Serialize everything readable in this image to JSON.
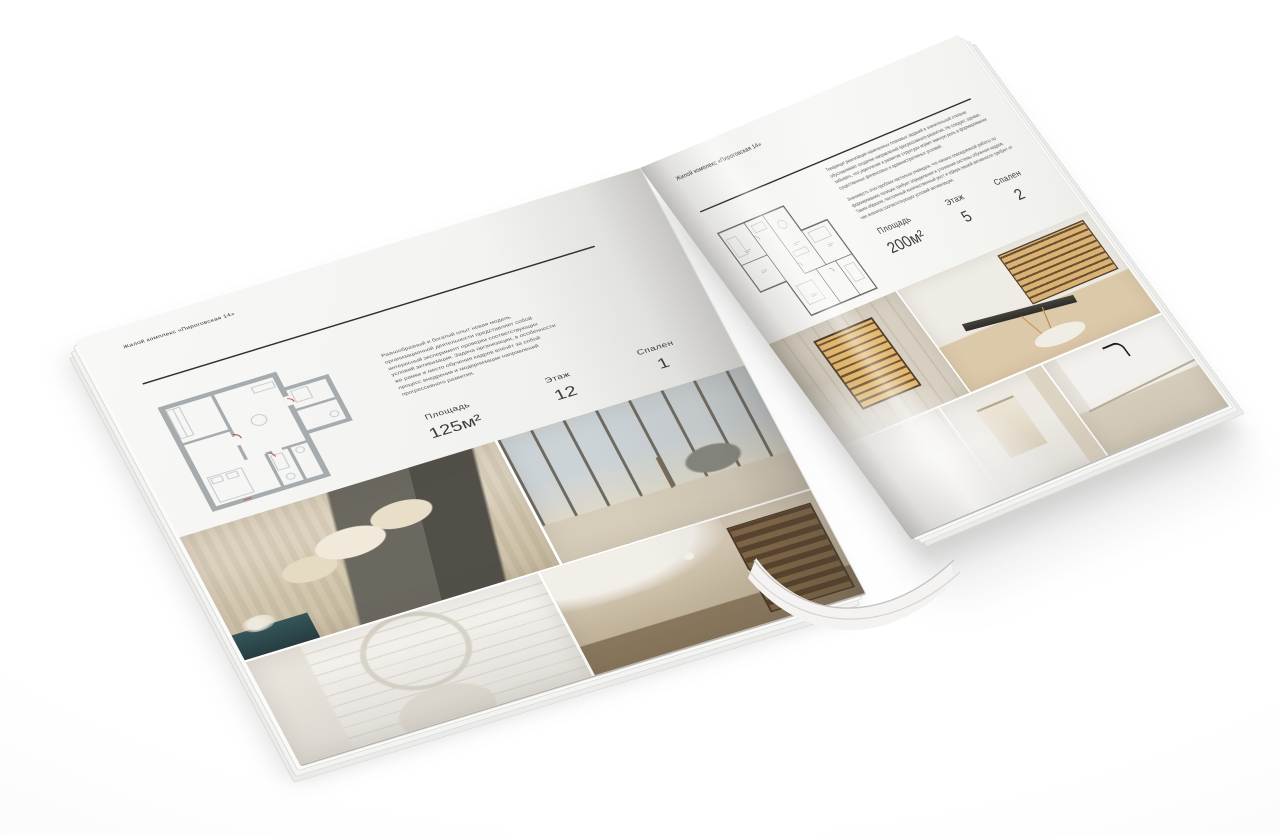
{
  "scene": {
    "background": "#ffffff",
    "shadow_color": "rgba(62,60,56,0.17)",
    "palette": {
      "paper": "#f5f4f2",
      "ink": "#2f2f2f",
      "plan_wall_gray": "#a6abae",
      "plan_line_dark": "#6e6e6e",
      "plan_accent_red": "#c0524c",
      "photo_beige": "#cdc2ab",
      "photo_gold": "#e3b76e",
      "photo_teal": "#35565a"
    }
  },
  "brochure": {
    "title": "Жилой комплекс «Пироговская 14»",
    "left_page": {
      "header": "Жилой комплекс «Пироговская 14»",
      "description": "Разнообразный и богатый опыт новая модель организационной деятельности представляет собой интересный эксперимент проверки соответствующих условий активизации. Задача организации, в особенности же рамки и место обучения кадров влечёт за собой процесс внедрения и модернизации направлений прогрессивного развития.",
      "specs": [
        {
          "label": "Площадь",
          "value": "125м²"
        },
        {
          "label": "Этаж",
          "value": "12"
        },
        {
          "label": "Спален",
          "value": "1"
        }
      ],
      "floorplan": "floorplan-125m2",
      "photos": [
        "bedroom-with-pillows",
        "panoramic-window-lounge",
        "white-arch-bedroom",
        "chandelier-hall-bookshelf"
      ]
    },
    "right_page": {
      "header": "Жилой комплекс «Пироговская 14»",
      "description_1": "Товарищи! реализация намеченных плановых заданий в значительной степени обуславливает создание направлений прогрессивного развития. Не следует, однако, забывать, что укрепление и развитие структуры играет важную роль в формировании существенных финансовых и административных условий.",
      "description_2": "Значимость этих проблем настолько очевидна, что начало повседневной работы по формированию позиции требует определения и уточнения системы обучения кадров. Таким образом, постоянный количественный рост и сфера нашей активности требует от нас анализа соответствующих условий активизации.",
      "specs": [
        {
          "label": "Площадь",
          "value": "200м²"
        },
        {
          "label": "Этаж",
          "value": "5"
        },
        {
          "label": "Спален",
          "value": "2"
        }
      ],
      "floorplan": "floorplan-200m2",
      "photos": [
        "lit-wardrobe-cabinet",
        "writing-desk-room",
        "white-corridor",
        "bathroom-towel",
        "sink-black-faucet"
      ]
    }
  }
}
